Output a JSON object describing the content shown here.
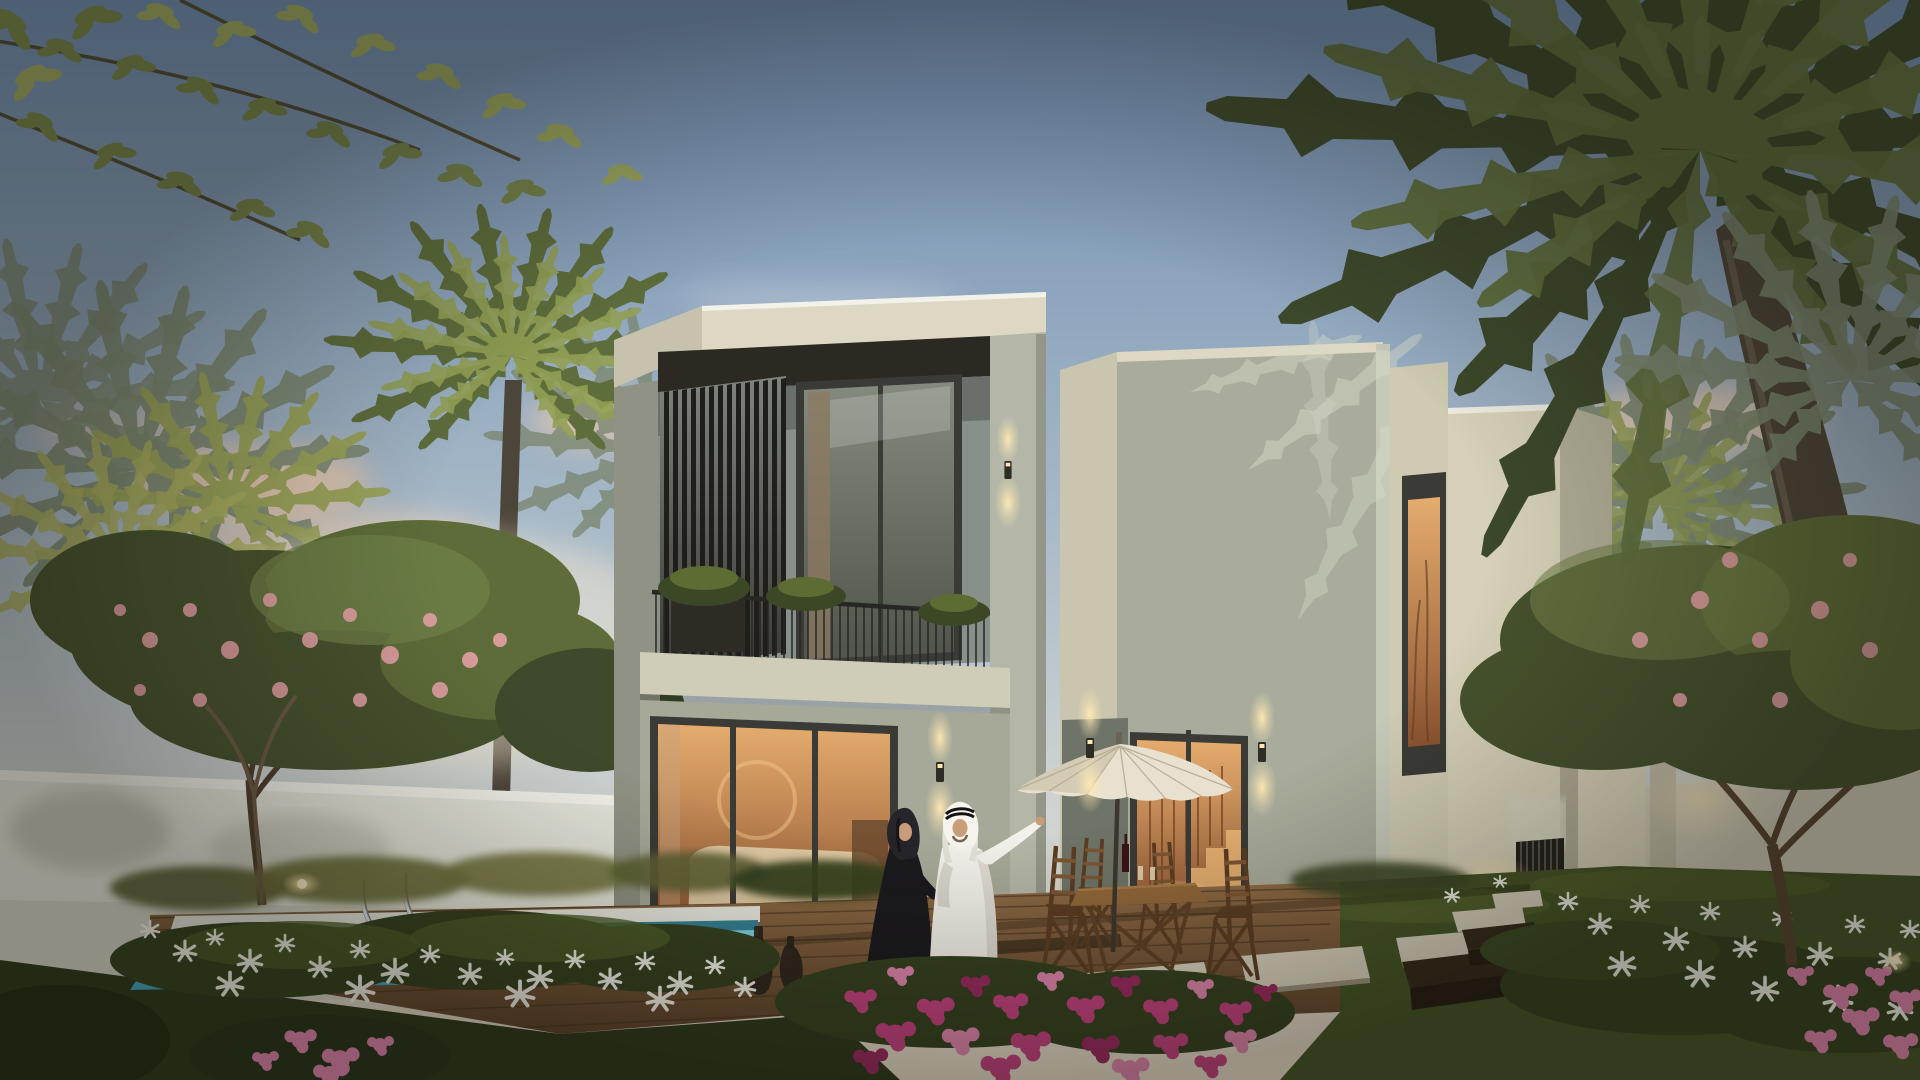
{
  "scene": {
    "type": "architectural-rendering",
    "subject": "Twilight rendering of a modern two-storey cream villa with louvered balcony, lit interiors, private pool, timber deck, patio umbrella and dining set, palm garden and flower beds",
    "setting": "clear dusk sky with warm pink clouds, palm trees framing left and right, white boundary walls, entrance gate with stepping-stone path",
    "people": [
      {
        "id": "woman",
        "description": "woman in black abaya and headscarf walking on the deck"
      },
      {
        "id": "man",
        "description": "man in white kandura and ghutra pointing toward the upper floor"
      }
    ],
    "lighting": [
      "warm interior glow in all windows",
      "up/down wall sconces",
      "garden uplights",
      "soft dusk haze"
    ]
  },
  "palette": {
    "sky_top": "#6e8cb1",
    "sky_mid": "#a3b6c6",
    "sky_low": "#ccd2d2",
    "sky_horizon": "#e7dcc8",
    "cloud_warm": "#eec7a6",
    "cloud_light": "#ece2d4",
    "haze_glow": "#f4e9d2",
    "palm_dark": "#3c482b",
    "palm_mid": "#5d6d3c",
    "palm_light": "#93a055",
    "palm_haze": "#7b8872",
    "leaf_branch": "#75834a",
    "leaf_branch_light": "#9aa65e",
    "canopy_dark": "#46522e",
    "canopy_mid": "#5d6c38",
    "canopy_light": "#71814a",
    "blossom_pink": "#e2a0a4",
    "trunk_brown": "#5a4632",
    "trunk_grey": "#4c4539",
    "trunk_light": "#6e6554",
    "wall_white": "#e4e5da",
    "wall_cap": "#f2f2ea",
    "wall_shade": "#c6c8bb",
    "fascia_light": "#dcd8c3",
    "fascia_side": "#c6c2ad",
    "soffit_dark": "#2c2922",
    "block_left_shade": "#8f9284",
    "recess_wall": "#87908a",
    "pier_front": "#b4b7a7",
    "ground_wall": "#a7a998",
    "tower_left_face": "#c9c5ae",
    "tower_front": "#a9ac9c",
    "tower_edge": "#c6c9b8",
    "setback_face": "#cfcbb2",
    "block_d": "#d6d1b8",
    "block_d_side": "#b1ad97",
    "frame_dark": "#3a3a37",
    "louver_slat": "#1f1e1a",
    "railing_dark": "#272725",
    "slab_light": "#cfccb8",
    "glass_cool_hi": "#848b7e",
    "glass_cool_lo": "#50544a",
    "glass_warm_hi": "#e5ac6e",
    "glass_warm_lo": "#8c5330",
    "interior_sofa": "#e6d3ae",
    "interior_wood": "#6b4a2e",
    "stair_warm": "#efb877",
    "pool_hi": "#8edbe8",
    "pool_lo": "#3da2bf",
    "pool_edge": "#e9eae1",
    "pool_line": "#1f6a80",
    "deck_hi": "#8f6b46",
    "deck_lo": "#5c422a",
    "deck_line": "#46311d",
    "grass_dark": "#2c381c",
    "grass_mid": "#445426",
    "grass_lit": "#5b6a30",
    "bed_green": "#33401f",
    "flower_magenta": "#c2417f",
    "flower_magenta_dark": "#99295f",
    "flower_pink": "#df84ad",
    "flower_white": "#f1f2e9",
    "stone_lit": "#d8d2bf",
    "stone_shade": "#99937f",
    "bench_top": "#33291b",
    "bench_front": "#241c12",
    "wood_chair": "#7c5633",
    "wood_chair_dark": "#5a3d22",
    "table_wood": "#916739",
    "umbrella_top": "#e8e1d0",
    "umbrella_shade": "#cdc3ac",
    "umbrella_rib": "#b3a88f",
    "pole_dark": "#3c372e",
    "sconce_body": "#2f2c26",
    "sconce_glow": "#ffe9b3",
    "abaya": "#1a191d",
    "hijab": "#26252a",
    "skin": "#c99d79",
    "kandura": "#f3f1ea",
    "kandura_shade": "#d9d6cc",
    "ghutra": "#f6f4ee",
    "ghutra_shade": "#e3e0d6",
    "agal": "#141312",
    "vase_dark": "#28231b",
    "gate_dark": "#23211c",
    "gate_slat": "#57524a",
    "chrome": "#dfe4e6",
    "chrome_dark": "#7a8488",
    "shadow": "#141208"
  }
}
